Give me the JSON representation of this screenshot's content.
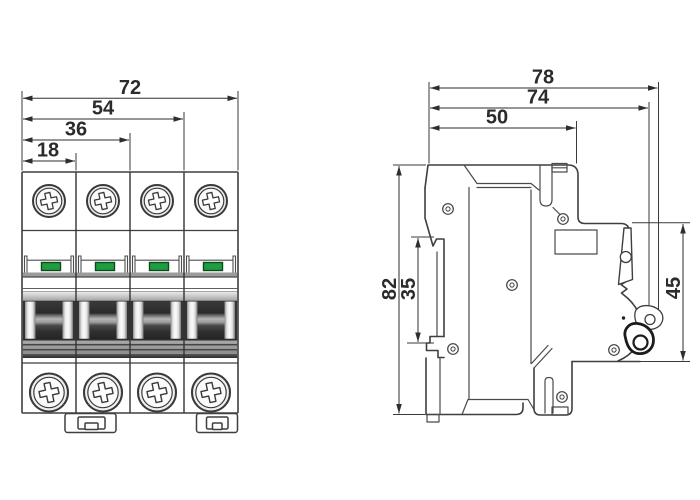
{
  "dimensions": {
    "front": {
      "overall_width": "72",
      "width_three_poles": "54",
      "width_two_poles": "36",
      "width_one_pole": "18"
    },
    "side": {
      "overall_depth": "78",
      "depth_to_pivot": "74",
      "top_face_depth": "50",
      "height": "82",
      "din_recess_height": "35",
      "front_height": "45"
    }
  },
  "colors": {
    "indicator_green": "#1f9e41",
    "indicator_green_border": "#0d4a1c",
    "outline": "#3f3f3f",
    "dimension_text": "#2b2b2b",
    "handle_dark": "#2e2e2e"
  }
}
